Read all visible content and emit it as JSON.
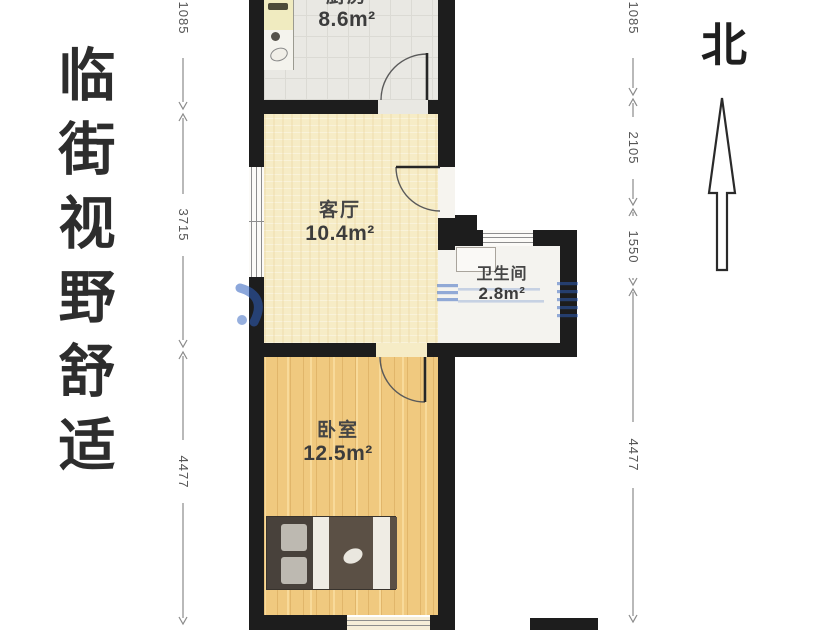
{
  "headline": {
    "text": "临街视野舒适",
    "chars": [
      "临",
      "街",
      "视",
      "野",
      "舒",
      "适"
    ]
  },
  "compass": {
    "label": "北"
  },
  "rooms": [
    {
      "id": "kitchen",
      "name": "厨房",
      "area": "8.6m²"
    },
    {
      "id": "living",
      "name": "客厅",
      "area": "10.4m²"
    },
    {
      "id": "bathroom",
      "name": "卫生间",
      "area": "2.8m²"
    },
    {
      "id": "bedroom",
      "name": "卧室",
      "area": "12.5m²"
    }
  ],
  "dimensions": {
    "left": [
      "1085",
      "3715",
      "4477"
    ],
    "right": [
      "1085",
      "2105",
      "1550",
      "4477"
    ]
  },
  "colors": {
    "wall": "#1d1d1d",
    "kitchen_floor": "#e9e8e3",
    "living_floor": "#f6ecc6",
    "bedroom_floor": "#f0c97f",
    "bathroom_floor": "#f4f3ef",
    "watermark_blue": "#2d5fbe",
    "text_dark": "#2d2d2d",
    "dimension_gray": "#555555"
  }
}
